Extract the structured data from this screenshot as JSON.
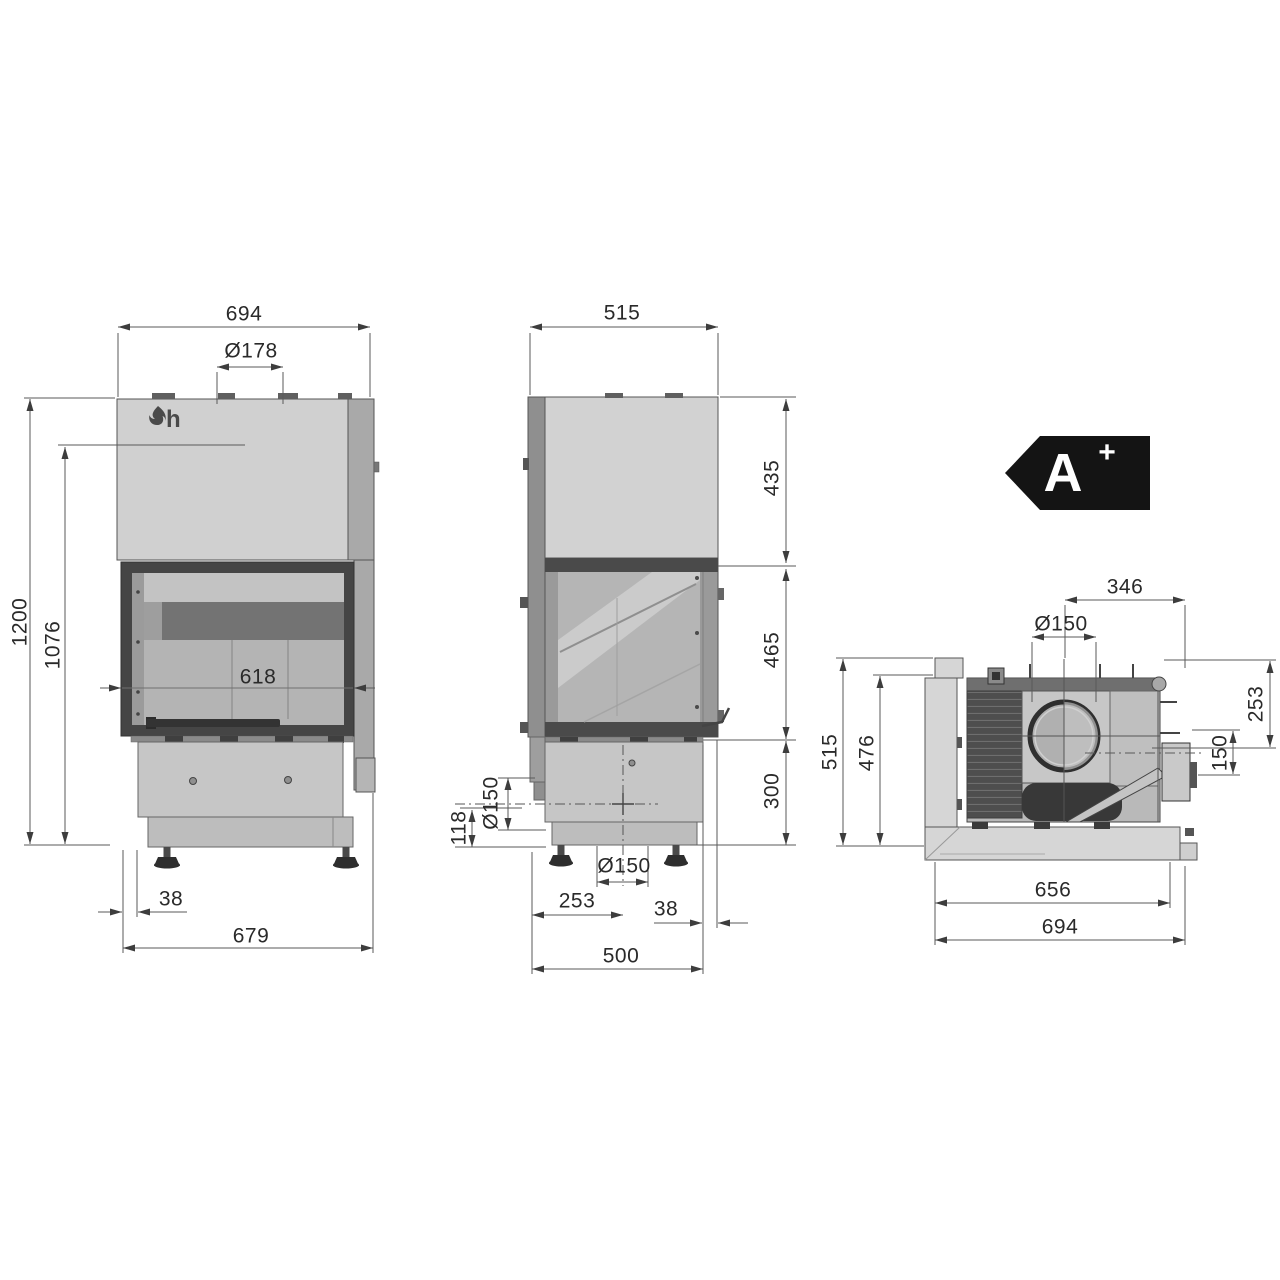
{
  "brand": {
    "logo_letter": "h"
  },
  "energy_label": {
    "grade": "A",
    "plus": "+"
  },
  "front_view": {
    "dim_overall_width": "694",
    "dim_flue_diameter": "Ø178",
    "dim_overall_height": "1200",
    "dim_body_height": "1076",
    "dim_glass_width": "618",
    "dim_left_offset": "38",
    "dim_base_width": "679"
  },
  "side_view": {
    "dim_overall_depth": "515",
    "dim_hood_section": "435",
    "dim_glass_section": "465",
    "dim_base_section": "300",
    "dim_rear_outlet_diameter": "Ø150",
    "dim_rear_outlet_height": "118",
    "dim_bottom_outlet_diameter": "Ø150",
    "dim_bottom_outlet_offset": "253",
    "dim_rear_offset": "38",
    "dim_base_depth": "500"
  },
  "top_view": {
    "dim_flue_to_back": "346",
    "dim_flue_diameter": "Ø150",
    "dim_overall_depth": "515",
    "dim_body_depth": "476",
    "dim_rear_section": "253",
    "dim_rear_outlet": "150",
    "dim_body_width": "656",
    "dim_overall_width": "694"
  }
}
